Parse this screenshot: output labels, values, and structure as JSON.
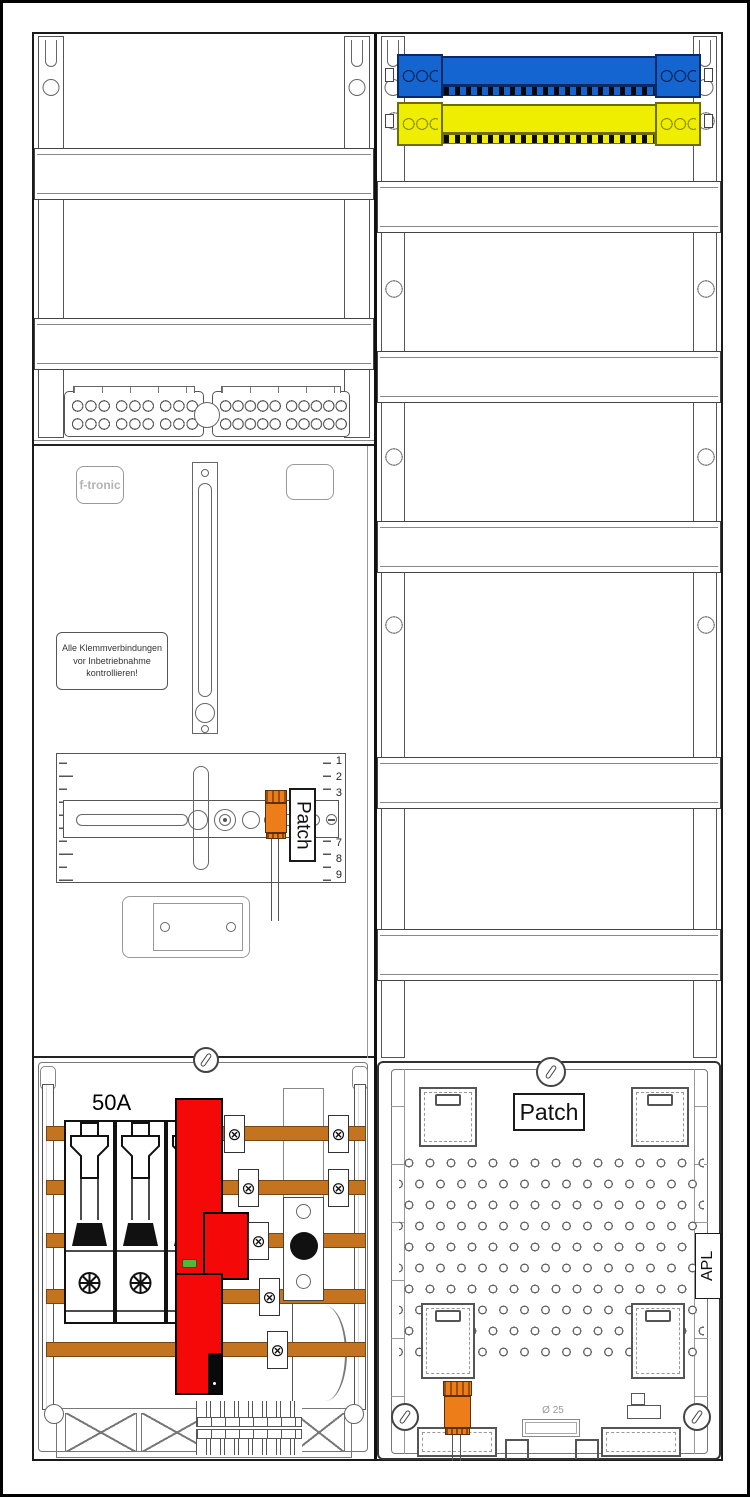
{
  "labels": {
    "brand": "f-tronic",
    "warning_line1": "Alle Klemmverbindungen",
    "warning_line2": "vor Inbetriebnahme",
    "warning_line3": "kontrollieren!",
    "amperage": "50A",
    "patch_left": "Patch",
    "patch_right": "Patch",
    "apl": "APL",
    "diameter": "Ø 25"
  },
  "meter_ruler": {
    "top": [
      "1",
      "2",
      "3"
    ],
    "bottom": [
      "7",
      "8",
      "9"
    ]
  },
  "colors": {
    "neutral_busbar_blue": "#1565d0",
    "pe_busbar_yellow": "#f0ee00",
    "sls_switch_red": "#f40808",
    "copper_busbar_orange": "#c4731e",
    "terminal_block_orange": "#ed7d18",
    "status_indicator_green": "#57b535"
  }
}
